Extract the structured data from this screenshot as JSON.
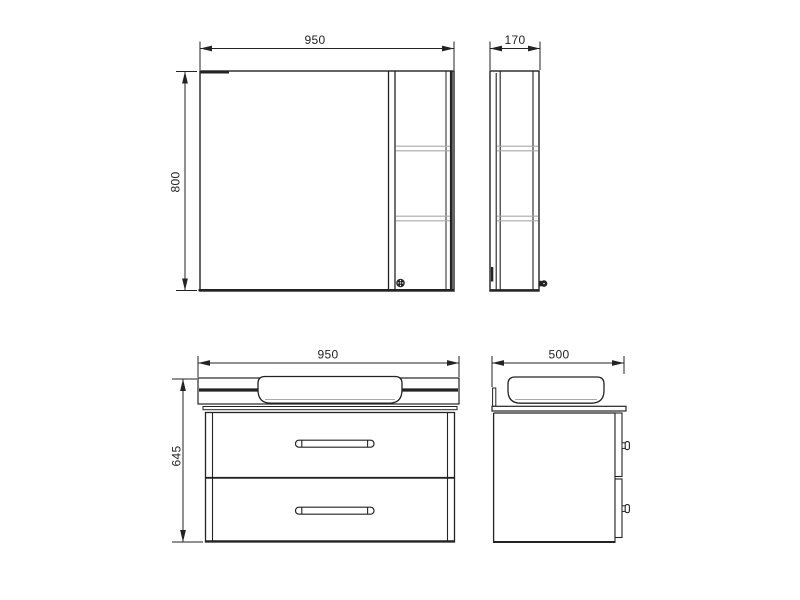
{
  "colors": {
    "line": "#232323",
    "shelf": "#a9a9a9",
    "bg": "#ffffff"
  },
  "views": {
    "mirror_front": {
      "width": "950",
      "height": "800"
    },
    "mirror_side": {
      "depth": "170"
    },
    "vanity_front": {
      "width": "950",
      "height": "645"
    },
    "vanity_side": {
      "depth": "500"
    }
  }
}
